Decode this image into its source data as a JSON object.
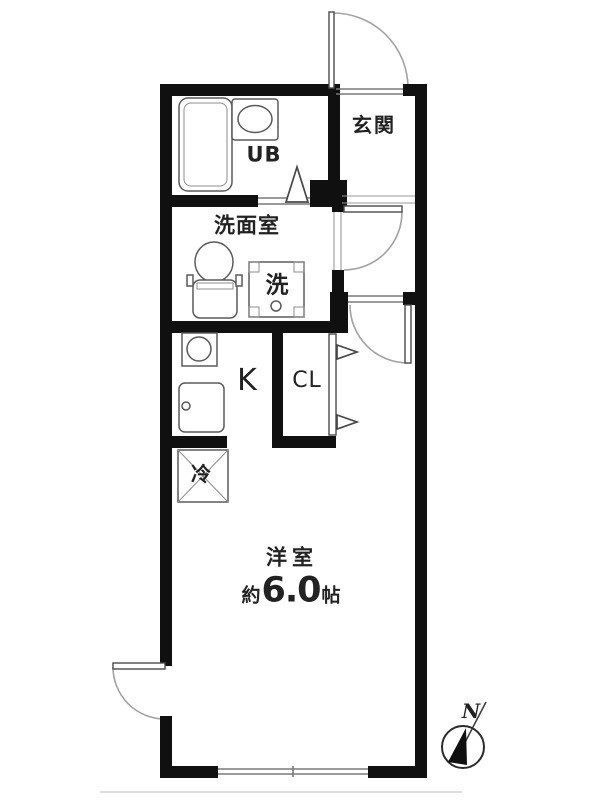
{
  "colors": {
    "background": "#ffffff",
    "wall": "#101010",
    "door_arc": "#a2a2a2",
    "fixture_line": "#5a5a5a",
    "thin_line": "#787878",
    "text": "#222222"
  },
  "rooms": {
    "entrance": {
      "label": "玄関"
    },
    "unit_bath": {
      "label": "UB"
    },
    "washroom": {
      "label": "洗面室"
    },
    "kitchen": {
      "label": "K"
    },
    "closet": {
      "label": "CL"
    },
    "main_room": {
      "label": "洋室",
      "size_prefix": "約",
      "size_value": "6.0",
      "size_unit": "帖"
    }
  },
  "fixtures": {
    "washing_machine_label": "洗",
    "refrigerator_label": "冷"
  },
  "compass": {
    "north_label": "N"
  },
  "icons": {
    "bathtub-icon": "rounded-rect-tub",
    "wash-basin-icon": "ellipse-in-counter",
    "toilet-icon": "oval-bowl-with-tank",
    "washing-machine-pan-icon": "square-pan-with-drain-circle",
    "stove-icon": "circle-in-square",
    "kitchen-sink-icon": "rounded-rect-with-faucet-dot",
    "refrigerator-space-icon": "box-with-diagonal-cross",
    "folding-door-icon": "triangle-in-doorway",
    "door-swing-icon": "quarter-circle-arc",
    "closet-door-arrow-icon": "hollow-right-triangle",
    "compass-icon": "circle-with-black-needle"
  }
}
